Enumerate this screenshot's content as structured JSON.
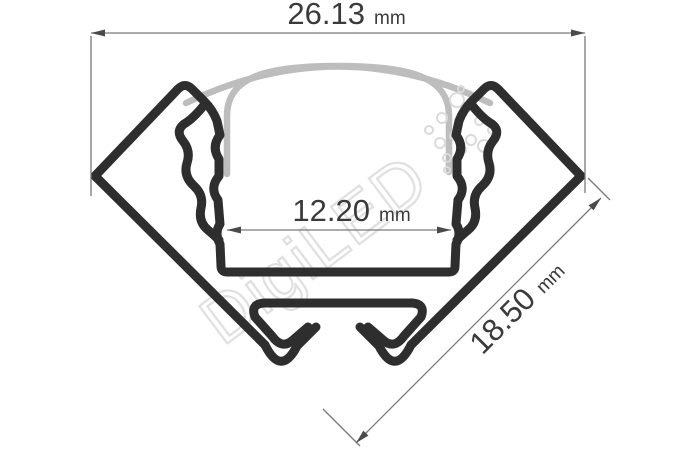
{
  "drawing": {
    "title": "LED aluminium corner profile cross-section",
    "dimensions": {
      "top_width": {
        "value": "26.13",
        "unit": "mm"
      },
      "inner_width": {
        "value": "12.20",
        "unit": "mm"
      },
      "side_depth": {
        "value": "18.50",
        "unit": "mm"
      }
    },
    "watermark": {
      "text": "DigiLED"
    },
    "colors": {
      "outline": "#2e2e2e",
      "cover": "#bdbdbd",
      "dimension_line": "#7a7a7a",
      "dimension_text": "#3a3a3a",
      "watermark": "#e0e0e0",
      "background": "#ffffff"
    }
  }
}
